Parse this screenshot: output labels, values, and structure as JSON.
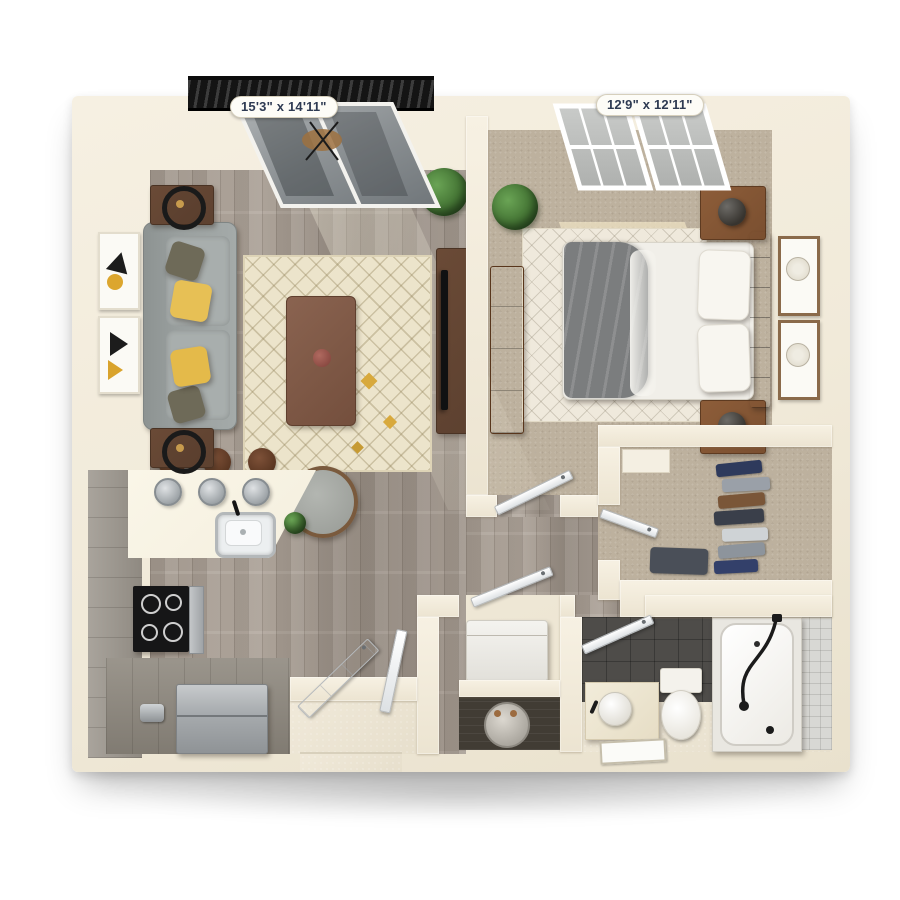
{
  "floorplan": {
    "type": "3d-top-down-one-bedroom-apartment-floorplan",
    "labels": {
      "living_room_dimensions": "15'3\" x 14'11\"",
      "bedroom_dimensions": "12'9\" x 12'11\""
    },
    "rooms": [
      {
        "name": "living-room",
        "dimensions": "15'3\" x 14'11\"",
        "floor": "wood",
        "furniture": [
          "sofa",
          "yellow-pillows",
          "olive-pillows",
          "end-tables",
          "ring-lamps",
          "wall-art-x2",
          "patterned-area-rug",
          "coffee-table",
          "accent-chair",
          "tv-console",
          "tv",
          "potted-plant",
          "sliding-glass-door"
        ]
      },
      {
        "name": "balcony",
        "furniture": [
          "black-railing",
          "bistro-table",
          "chairs"
        ]
      },
      {
        "name": "bedroom",
        "dimensions": "12'9\" x 12'11\"",
        "floor": "carpet",
        "furniture": [
          "bed",
          "gray-throw-blanket",
          "tufted-headboard",
          "pillows",
          "nightstands-x2",
          "dome-lamps-x2",
          "dresser",
          "chevron-rug",
          "wall-art-x2",
          "potted-plant",
          "window"
        ]
      },
      {
        "name": "walk-in-closet",
        "floor": "carpet",
        "furniture": [
          "hanging-clothes",
          "shelf"
        ]
      },
      {
        "name": "bathroom",
        "floor": "tile",
        "furniture": [
          "vanity",
          "vessel-sink",
          "mirror",
          "toilet",
          "bathtub",
          "shower-fixture",
          "dark-tile-wall"
        ]
      },
      {
        "name": "laundry-utility",
        "furniture": [
          "washer",
          "water-heater"
        ]
      },
      {
        "name": "kitchen",
        "floor": "wood",
        "furniture": [
          "peninsula-counter",
          "stainless-sink",
          "faucet",
          "pendant-lights-x3",
          "bar-stools-x3",
          "range-cooktop",
          "refrigerator",
          "toaster",
          "gray-cabinets"
        ]
      },
      {
        "name": "entry",
        "furniture": [
          "front-door",
          "threshold"
        ]
      }
    ],
    "palette": {
      "background": "#ffffff",
      "wall": "#f1ead9",
      "wall_shade": "#ddd3bd",
      "wood_floor": "#a89e94",
      "carpet": "#bdb19e",
      "rug_living": "#ece4cb",
      "rug_bedroom": "#efe9dc",
      "sofa": "#9aa09f",
      "pillow_yellow": "#e7c055",
      "table_wood": "#5d4130",
      "nightstand_wood": "#7a4f30",
      "bed_white": "#f1efe9",
      "blanket_gray": "#7b7d7e",
      "tile_dark": "#4e4c49",
      "counter_cream": "#f6f1e1",
      "cabinet_gray": "#9b958c",
      "stainless": "#a8acaf",
      "plant_green": "#4a7d3c",
      "railing_black": "#1d1d1d",
      "label_text": "#2e3a52",
      "label_bg": "#fdfcf7"
    }
  }
}
